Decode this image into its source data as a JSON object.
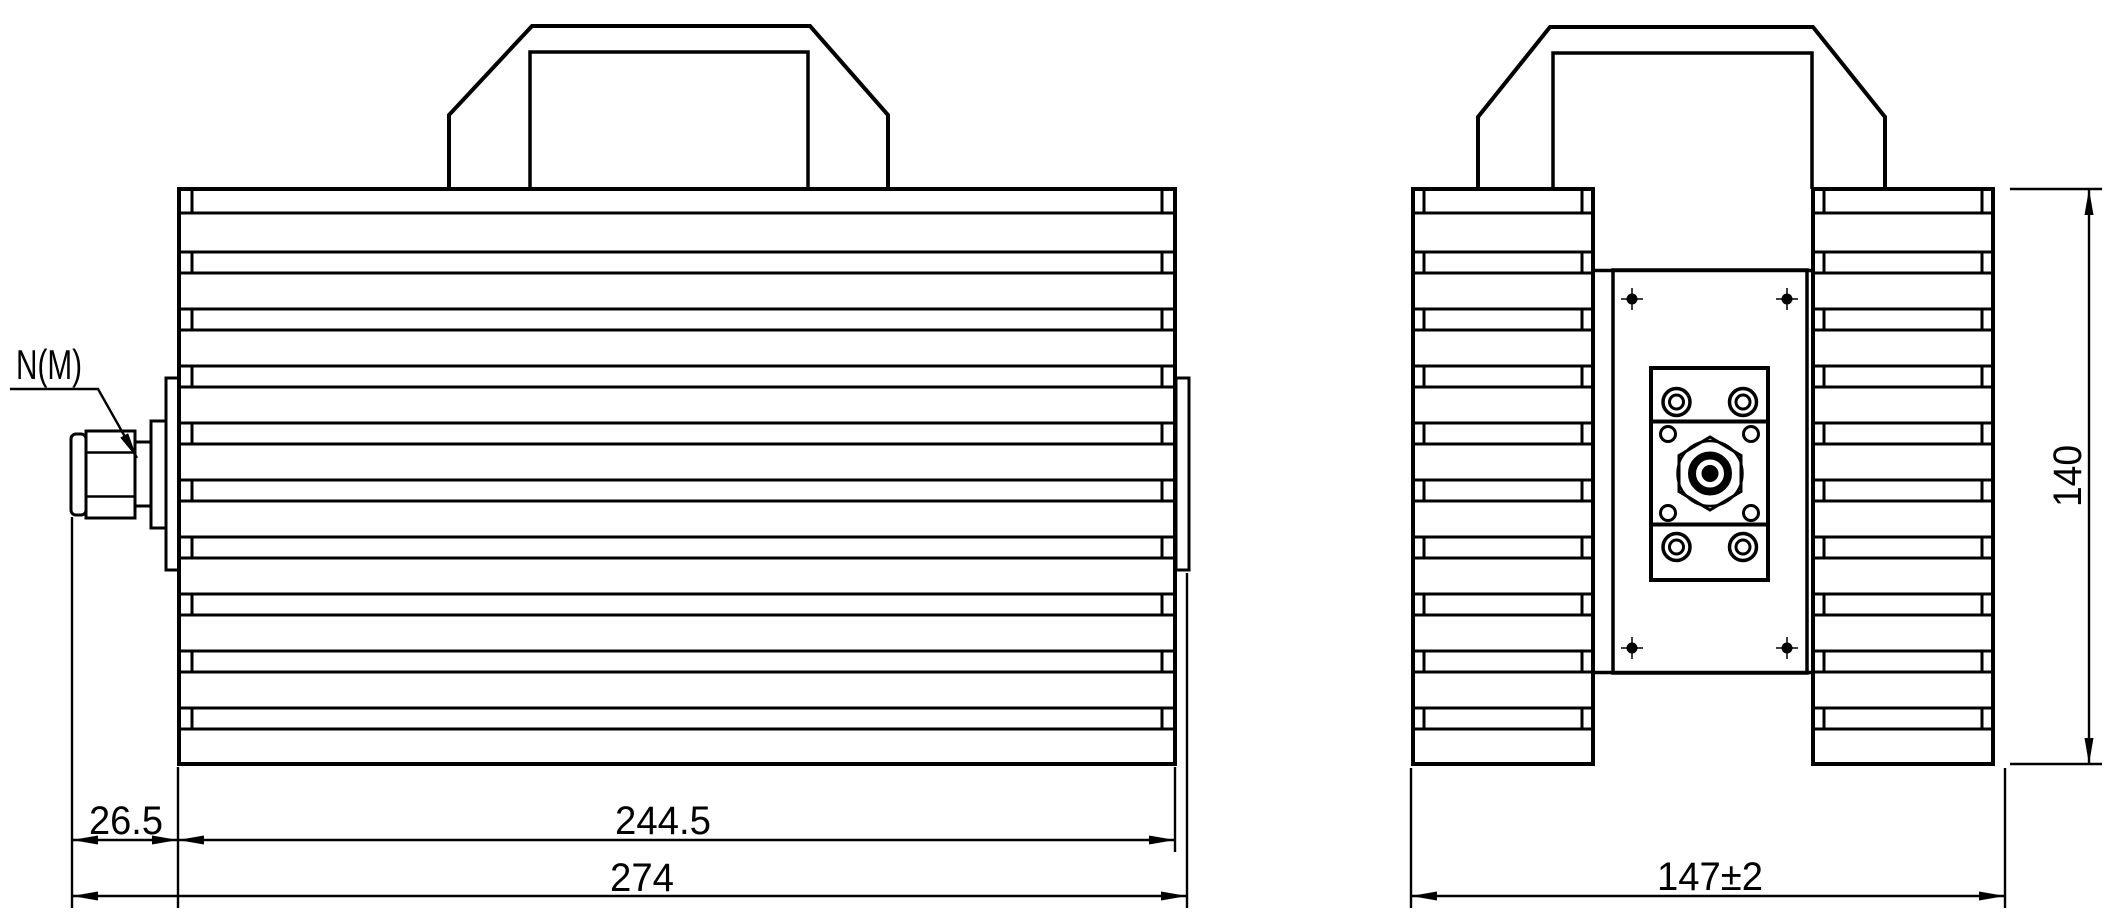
{
  "drawing": {
    "connector_label": "N(M)",
    "dimensions": {
      "connector_offset": "26.5",
      "body_length": "244.5",
      "overall_length": "274",
      "overall_width": "147±2",
      "overall_height": "140"
    },
    "colors": {
      "line": "#000000",
      "background": "#ffffff"
    }
  }
}
